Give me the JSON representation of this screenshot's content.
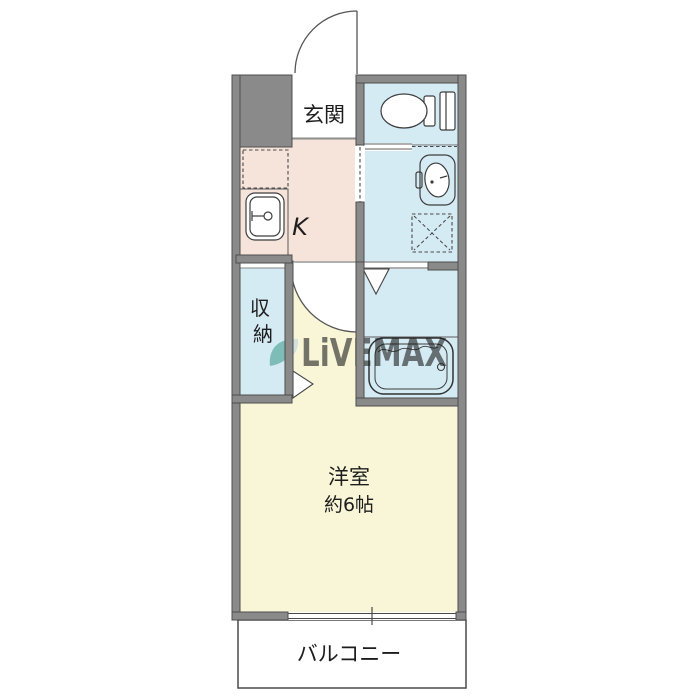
{
  "plan": {
    "rooms": {
      "genkan": {
        "label": "玄関"
      },
      "kitchen": {
        "label": "K"
      },
      "closet": {
        "label": "収納",
        "chars": [
          "収",
          "納"
        ]
      },
      "main_room": {
        "name": "洋室",
        "area": "約6帖"
      },
      "balcony": {
        "label": "バルコニー"
      }
    },
    "watermark": {
      "text": "LiVEMAX"
    },
    "fixtures": [
      "toilet-icon",
      "washbasin-icon",
      "washing-machine-space-icon",
      "refrigerator-space-icon",
      "kitchen-sink-icon",
      "bathtub-icon",
      "entrance-door-swing",
      "room-door-swing",
      "bath-door-triangle",
      "room-entry-triangle",
      "sliding-window"
    ],
    "colors": {
      "wall": "#8a8a8a",
      "outline": "#4d4d4d",
      "kitchen": "#f6e3da",
      "water_blue": "#d5ebf4",
      "room_yellow": "#f9f6d8",
      "balcony_white": "#ffffff",
      "watermark_text": "#a9c0d4",
      "watermark_leaf": "#45a08f",
      "label": "#1d1d1d"
    }
  }
}
